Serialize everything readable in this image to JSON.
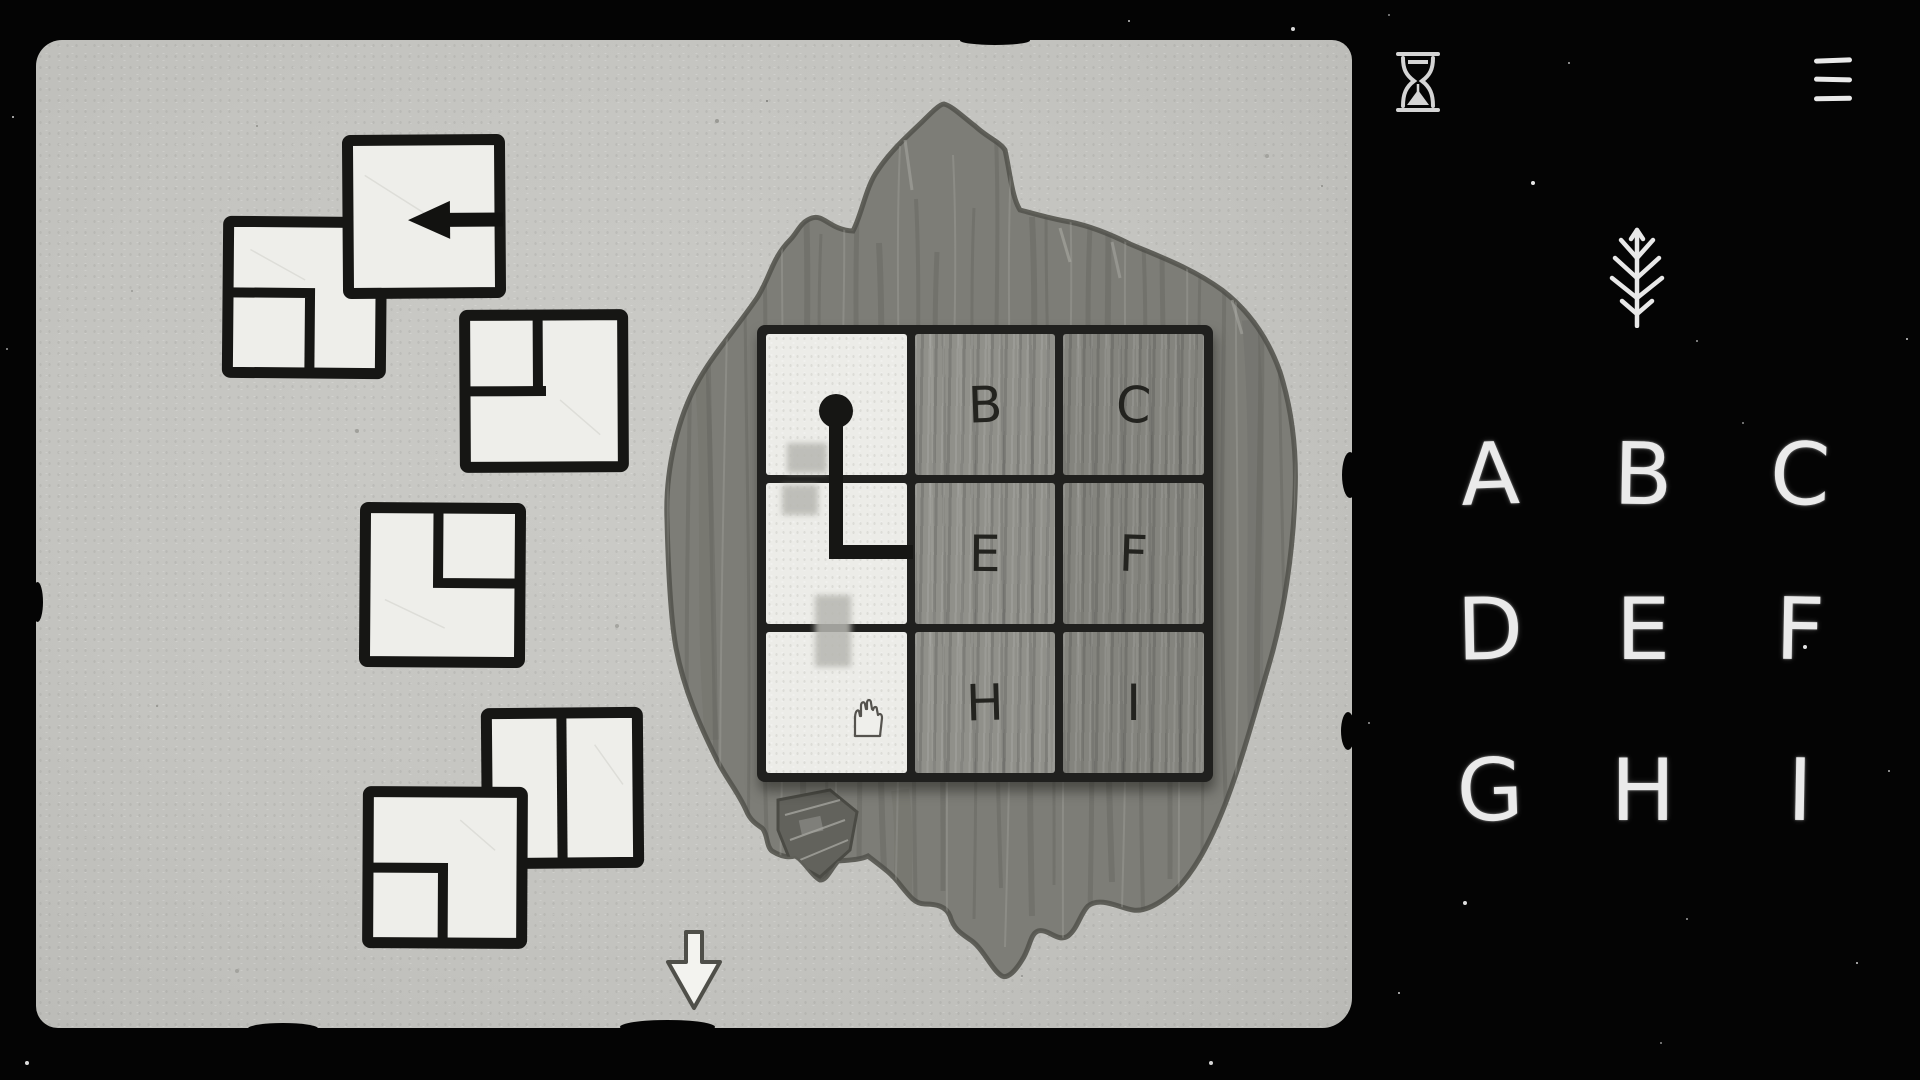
{
  "scene": {
    "name": "hand-drawn tile puzzle on paper mat"
  },
  "colors": {
    "background": "#040404",
    "paper": "#c6c6c2",
    "tile": "#eeeeea",
    "ink": "#181816",
    "wood": "#7d7d77",
    "wood_cell_middle": "#90908a",
    "wood_cell_right": "#84847e",
    "chalk": "#eaeaea",
    "smudge": "#b7b7b1"
  },
  "hud": {
    "hourglass_icon": "hourglass-icon",
    "menu_icon": "hamburger-menu-icon",
    "sapling_icon": "sapling-icon",
    "down_arrow_icon": "down-arrow-icon",
    "hand_icon": "hand-icon",
    "cursor_icon": "cursor-arrow-left-icon"
  },
  "board": {
    "cells": [
      {
        "id": "A",
        "label": "",
        "state": "cleared"
      },
      {
        "id": "B",
        "label": "B",
        "state": "covered"
      },
      {
        "id": "C",
        "label": "C",
        "state": "covered"
      },
      {
        "id": "D",
        "label": "",
        "state": "cleared"
      },
      {
        "id": "E",
        "label": "E",
        "state": "covered"
      },
      {
        "id": "F",
        "label": "F",
        "state": "covered"
      },
      {
        "id": "G",
        "label": "",
        "state": "cleared"
      },
      {
        "id": "H",
        "label": "H",
        "state": "covered"
      },
      {
        "id": "I",
        "label": "I",
        "state": "covered"
      }
    ],
    "path": {
      "start_cell": "A",
      "elbow_cell": "D",
      "shape": "dot-down-then-right"
    }
  },
  "pieces": [
    {
      "id": "piece-1",
      "shape": "full-square",
      "overlay": "cursor-arrow-left"
    },
    {
      "id": "piece-2",
      "shape": "square-inset-bottom-left"
    },
    {
      "id": "piece-3",
      "shape": "square-inset-top-left"
    },
    {
      "id": "piece-4",
      "shape": "square-inset-top-right"
    },
    {
      "id": "piece-5",
      "shape": "square-split-vertical"
    },
    {
      "id": "piece-6",
      "shape": "square-inset-bottom-left"
    }
  ],
  "legend": {
    "letters": [
      "A",
      "B",
      "C",
      "D",
      "E",
      "F",
      "G",
      "H",
      "I"
    ]
  }
}
